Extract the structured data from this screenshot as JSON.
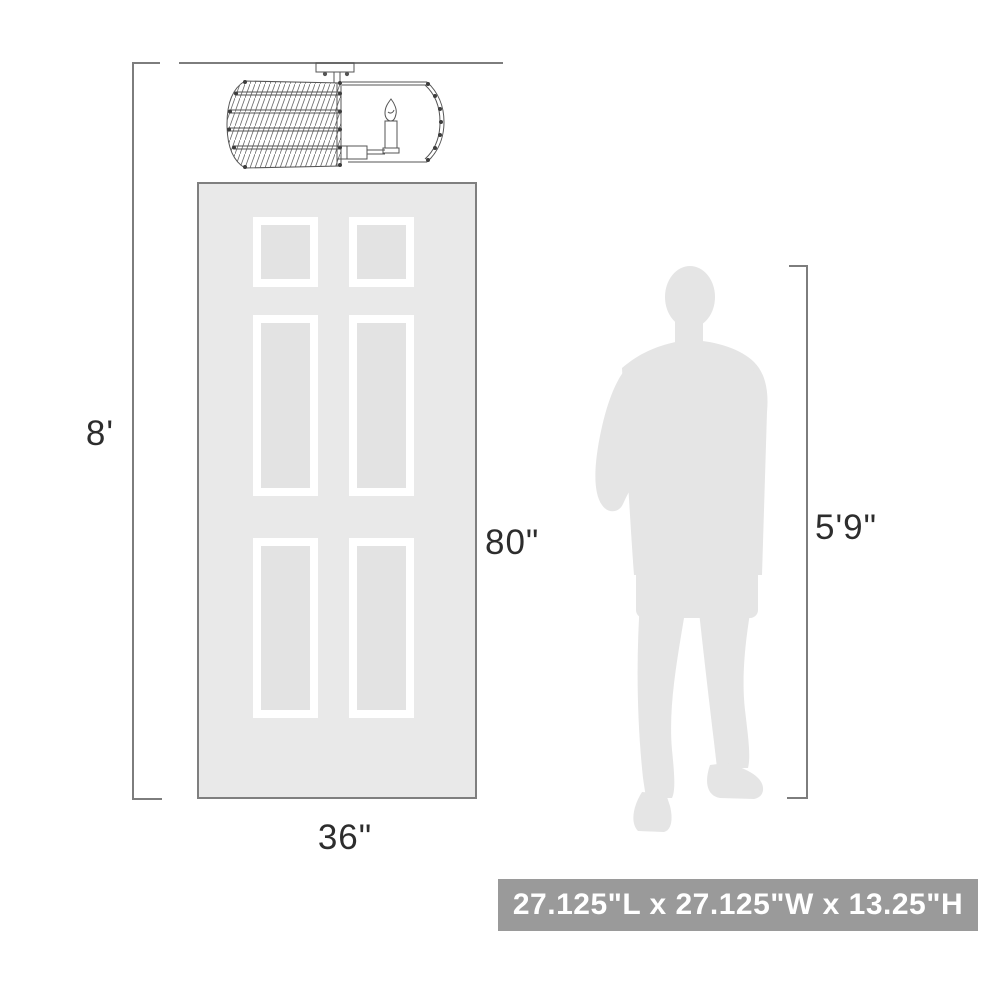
{
  "diagram": {
    "type": "product-scale-diagram",
    "labels": {
      "ceiling_height": "8'",
      "door_height": "80\"",
      "door_width": "36\"",
      "person_height": "5'9\""
    },
    "fixture": {
      "dimensions": "27.125\"L x 27.125\"W x 13.25\"H"
    },
    "colors": {
      "door_fill": "#e9e9e9",
      "door_panel_inner_fill": "#e3e3e3",
      "silhouette_fill": "#e5e5e5",
      "line_art": "#555555",
      "dimension_line": "#7d7d7d",
      "dimension_text": "#2d2d2d",
      "size_badge_bg": "#9a9a9a",
      "size_badge_text": "#ffffff"
    }
  }
}
